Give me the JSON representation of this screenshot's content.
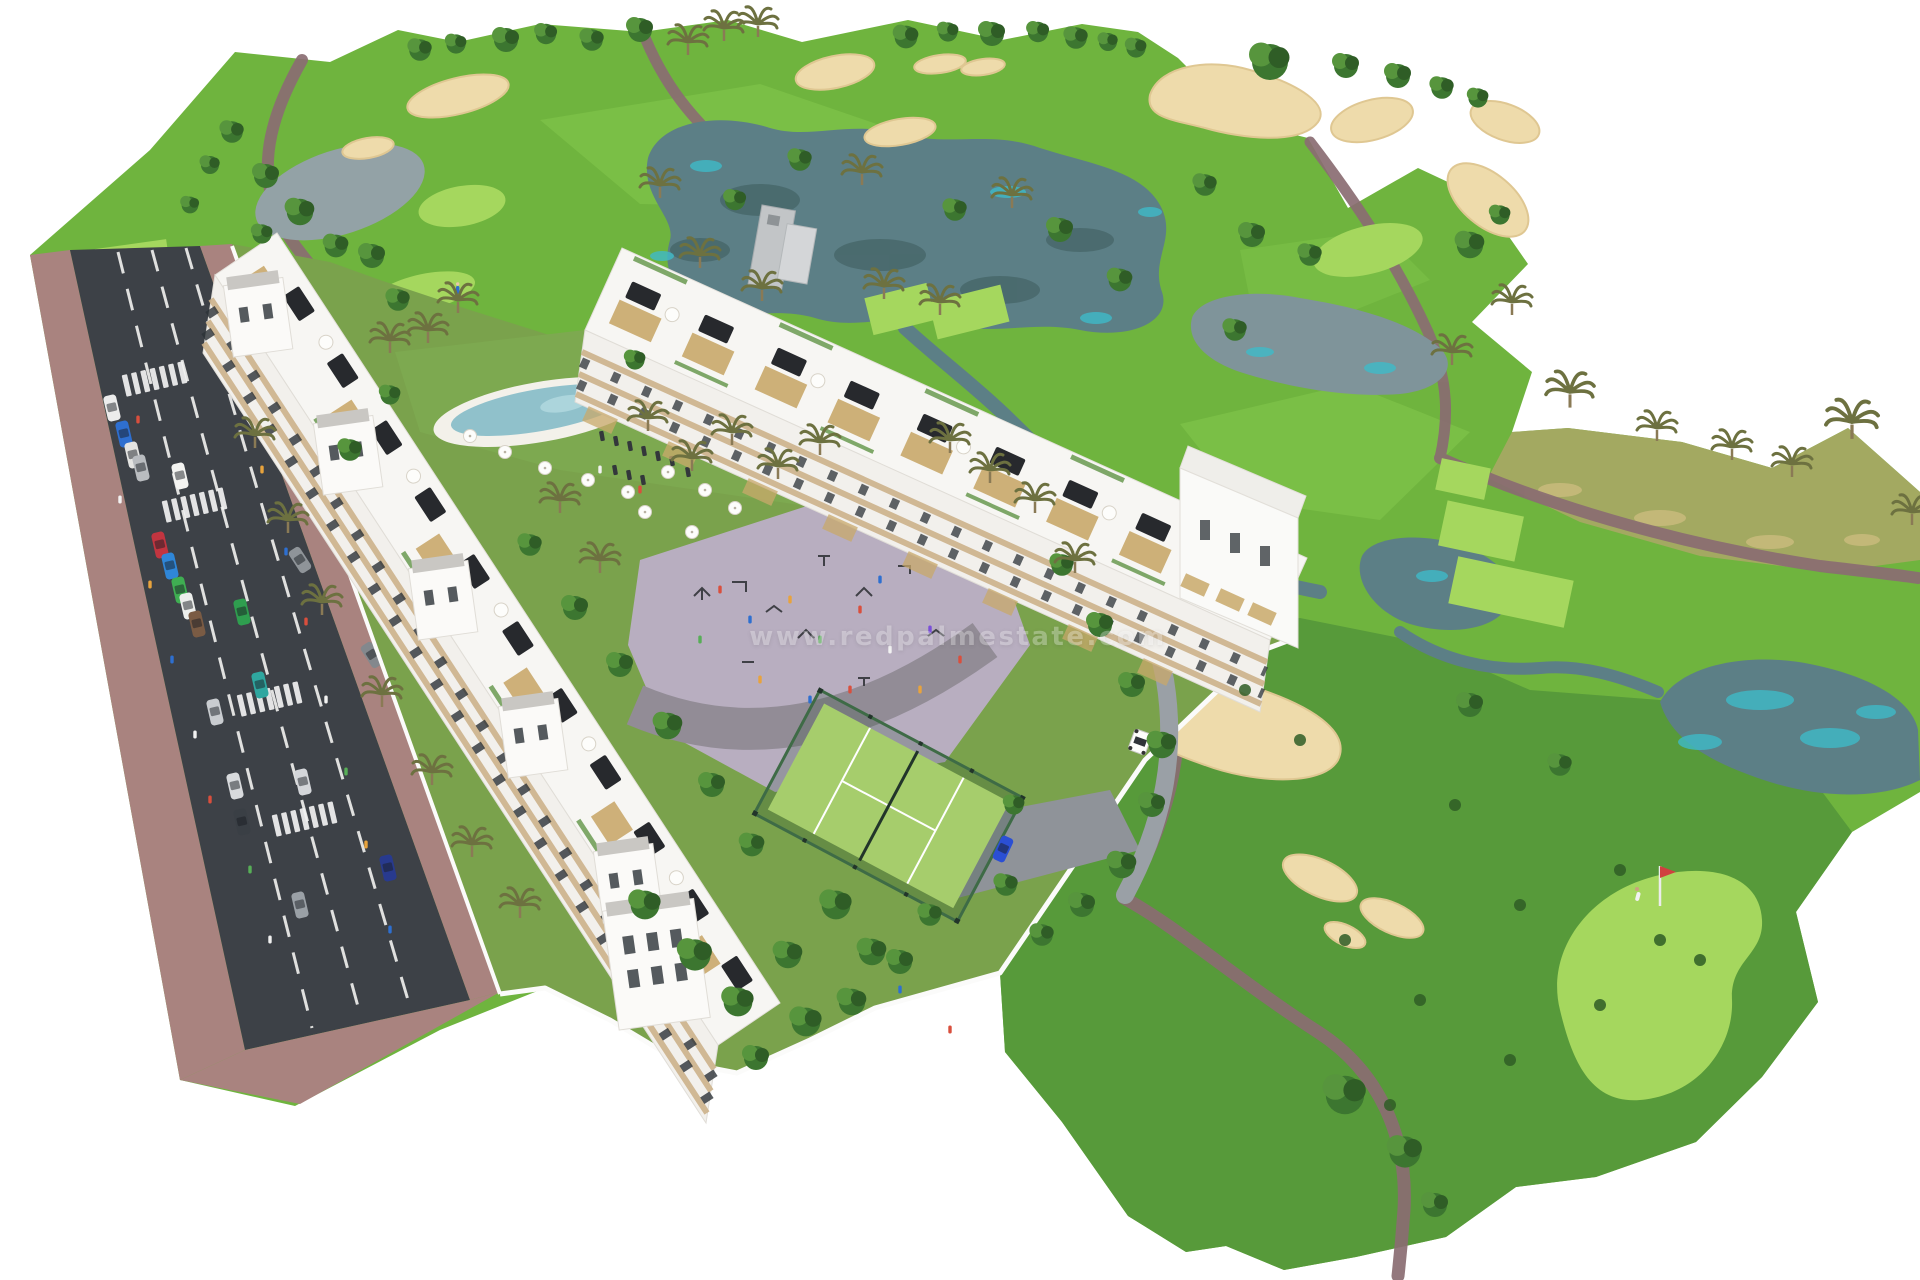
{
  "image": {
    "kind": "architectural-aerial-render",
    "description": "Aerial 3D render of a golf resort residential development: two long white apartment rows with roof terraces, lagoon pool, padel court, playground plaza, perimeter road with parked cars and zebra crossings, surrounded by golf fairways, lakes, sand bunkers, cart paths and a putting green with golfer and pin flag.",
    "background": "#ffffff"
  },
  "watermark": {
    "text": "www.redpalmestate.com",
    "color": "#ffffff",
    "opacity": 0.55
  },
  "palette": {
    "fairway": "#6fb43e",
    "fairway-light": "#85c94d",
    "green-bright": "#a5d75e",
    "rough": "#579a3a",
    "scrub": "#a9a765",
    "sand": "#eedbab",
    "sand-edge": "#dfc792",
    "water": "#5c7f86",
    "water-cyan": "#3fbac8",
    "water-gray": "#93a2a6",
    "cart-path": "#8a6c72",
    "asphalt": "#3d4147",
    "sidewalk": "#a9837f",
    "plaza": "#b8aec0",
    "plaza-path": "#928c96",
    "lawn": "#7aa24c",
    "bldg-white": "#f7f6f3",
    "bldg-face": "#f2f0ec",
    "facade-tan": "#cdb28b",
    "pergola": "#c9a96b",
    "canopy": "#27292d",
    "window": "#2c3237",
    "gravel": "#c9c7c3",
    "planter": "#6a9a50",
    "court": "#a6cd6c",
    "fence": "#3e6b46",
    "pool": "#90c1cb",
    "wall": "#fbfbfa",
    "tree-dark": "#3c7630",
    "tree-mid": "#57953d",
    "tree-deep": "#2f5d26",
    "palm": "#6d7140"
  },
  "features": {
    "buildings": [
      "west-apartment-row",
      "east-apartment-row",
      "corner-tower"
    ],
    "amenities": [
      "lagoon-pool",
      "padel-court",
      "playground-plaza",
      "sun-loungers",
      "white-umbrellas"
    ],
    "golf": [
      "fairways",
      "lakes",
      "sand-bunkers",
      "putting-green",
      "tee-boxes",
      "cart-paths",
      "golf-cart",
      "golfer",
      "pin-flag"
    ],
    "street": [
      "two-lane-road",
      "dashed-lane-markings",
      "zebra-crossings",
      "parked-cars",
      "sidewalks",
      "pedestrians"
    ],
    "parked_car_colors": [
      "white",
      "blue",
      "silver",
      "red",
      "green",
      "brown",
      "teal",
      "dark-gray",
      "navy"
    ]
  }
}
